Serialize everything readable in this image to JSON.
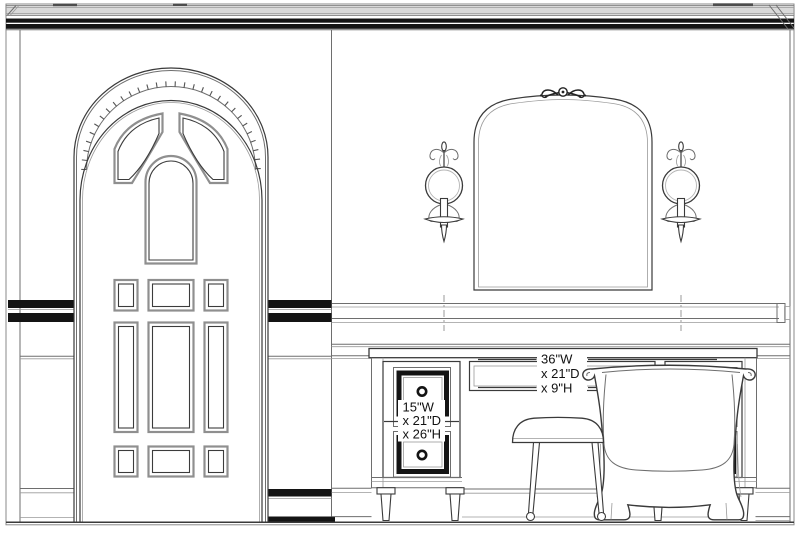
{
  "drawing": {
    "type": "interior-wall-elevation",
    "colors": {
      "line": "#3a3a3a",
      "line_light": "#9a9a9a",
      "fill_black": "#141414",
      "crown_gray": "#d9d9d9",
      "background": "#ffffff"
    },
    "components": [
      "crown-molding",
      "arched-panel-door",
      "wall-mirror",
      "sconce-left",
      "sconce-right",
      "chair-rail",
      "wainscot",
      "dressing-table",
      "vanity-stool",
      "freestanding-bathtub",
      "baseboard",
      "floor-line"
    ],
    "dimension_labels": {
      "center_drawer": {
        "line1": "36\"W",
        "line2": "x 21\"D",
        "line3": "x 9\"H"
      },
      "side_drawer": {
        "line1": "15\"W",
        "line2": "x 21\"D",
        "line3": "x 26\"H"
      }
    }
  }
}
